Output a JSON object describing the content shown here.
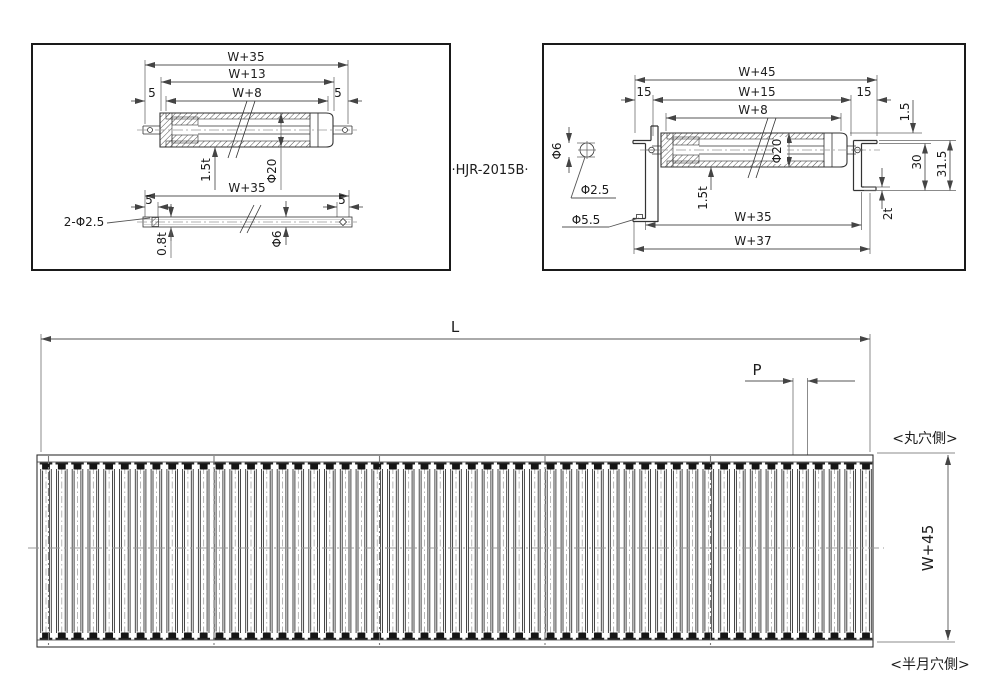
{
  "title": "HJR-2015B",
  "model_label": "·HJR-2015B·",
  "roller_side_view": {
    "dim_overall": "W+35",
    "dim_tube_with_cap": "W+13",
    "dim_tube_face": "W+8",
    "dim_end_left": "5",
    "dim_end_right": "5",
    "dim_wall": "1.5t",
    "dim_diameter": "Φ20",
    "shaft": {
      "dim_overall": "W+35",
      "dim_end_left": "5",
      "dim_end_right": "5",
      "dim_holes": "2-Φ2.5",
      "dim_wall": "0.8t",
      "dim_diameter": "Φ6"
    }
  },
  "frame_section_view": {
    "dim_frame_overall": "W+45",
    "dim_offset_left": "15",
    "dim_offset_right": "15",
    "dim_between_frames": "W+15",
    "dim_tube_face": "W+8",
    "dim_crown": "1.5",
    "dim_hole_dia": "Φ6",
    "dim_pin_hole": "Φ2.5",
    "dim_frame_hole": "Φ5.5",
    "dim_tube_dia": "Φ20",
    "dim_wall": "1.5t",
    "dim_frame_inner": "30",
    "dim_frame_height": "31.5",
    "dim_flange_thickness": "2t",
    "dim_shaft_span": "W+35",
    "dim_mount_span": "W+37"
  },
  "plan_view": {
    "dim_length": "L",
    "dim_pitch": "P",
    "dim_width": "W+45",
    "label_round_hole_side": "<丸穴側>",
    "label_half_moon_side": "<半月穴側>",
    "roller_count": 53
  },
  "colors": {
    "line": "#333333",
    "centerline": "#999999",
    "dim": "#555555",
    "background": "#ffffff"
  }
}
